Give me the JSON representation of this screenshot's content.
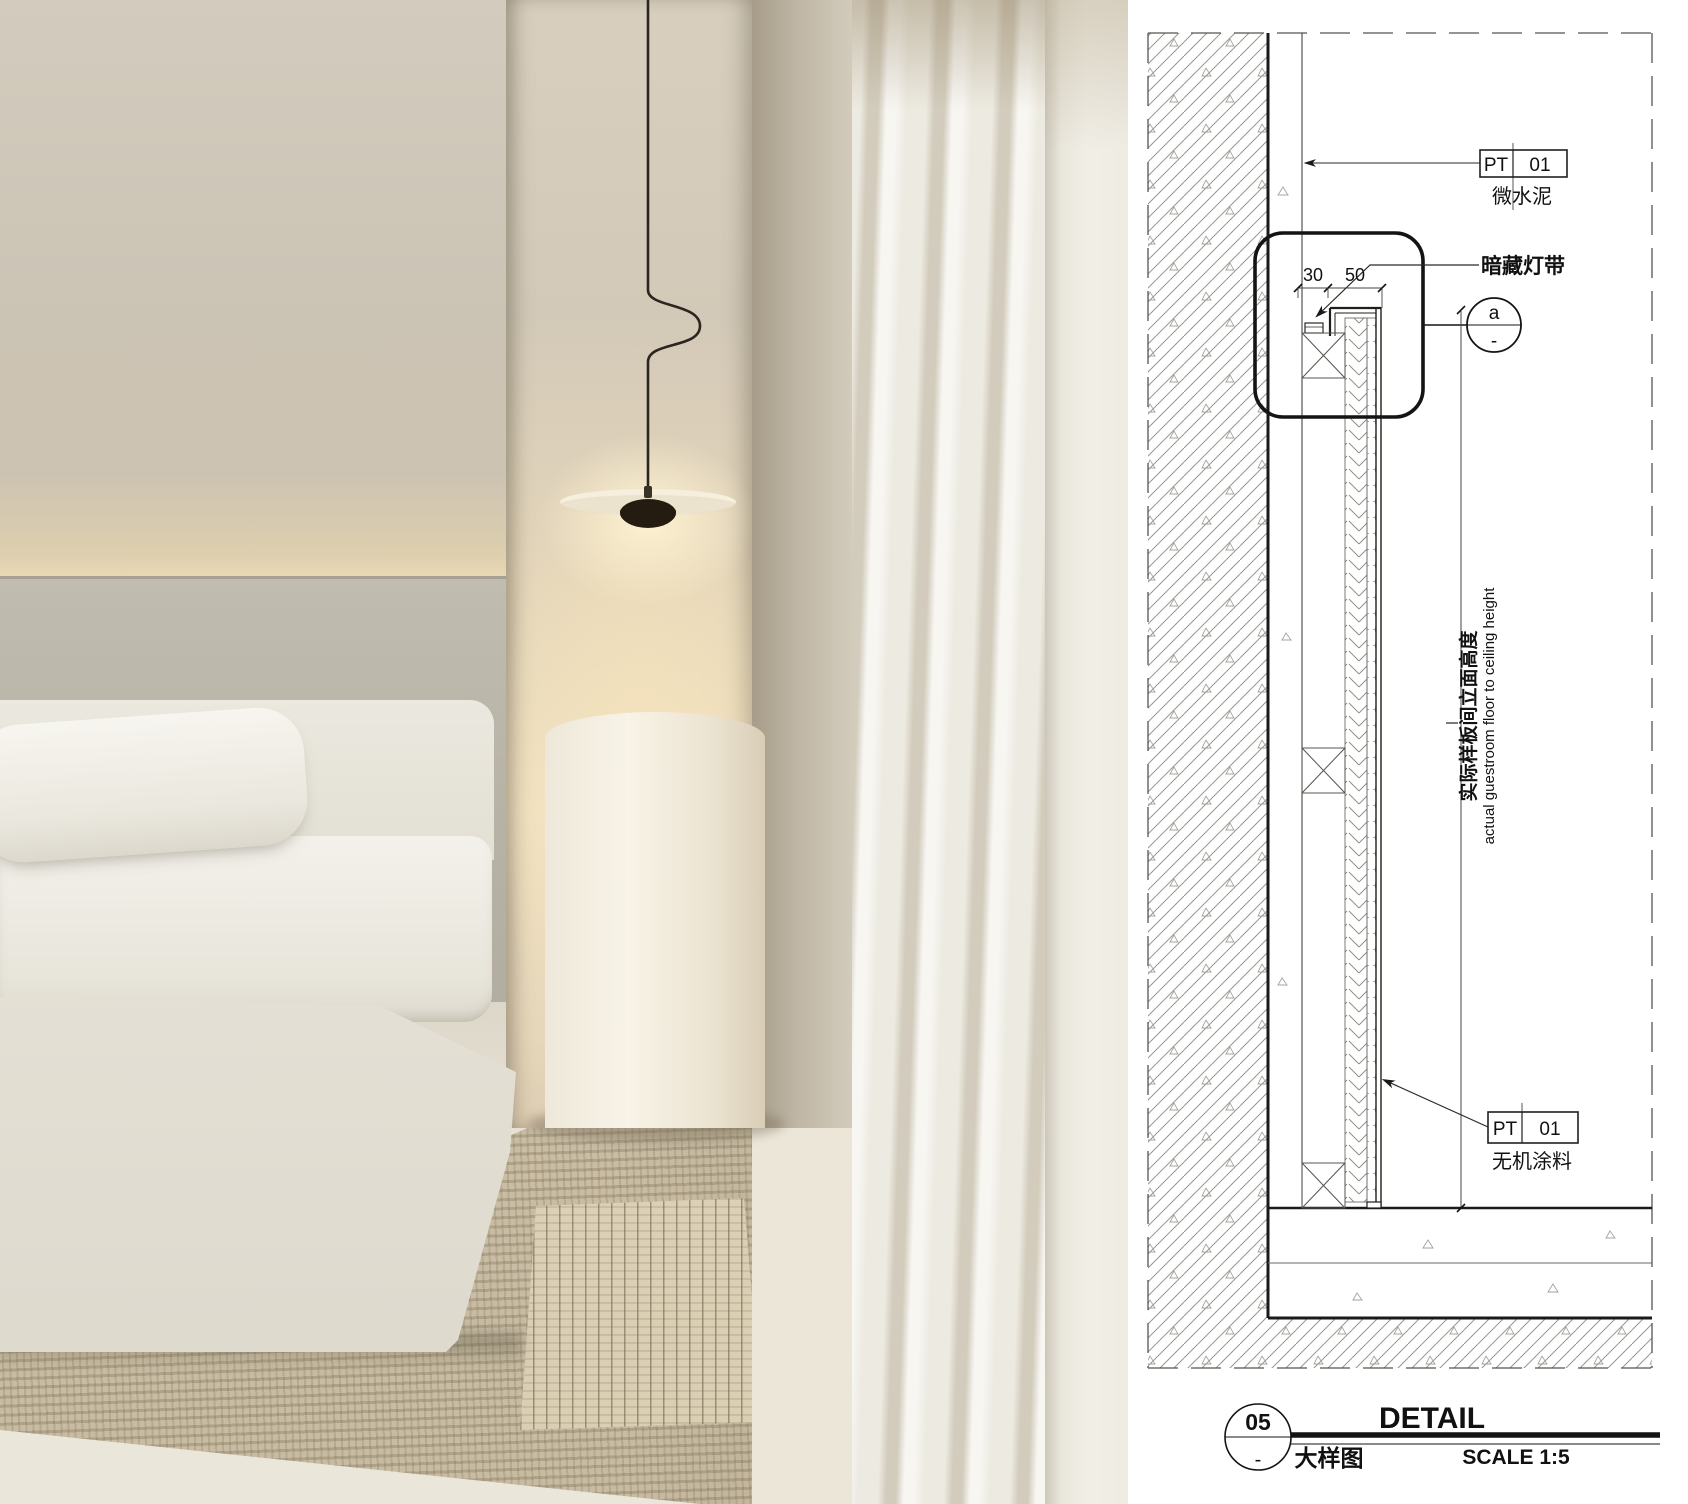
{
  "drawing": {
    "callouts": {
      "finish_top": {
        "tag_left": "PT",
        "tag_right": "01",
        "label": "微水泥"
      },
      "light_strip": {
        "label": "暗藏灯带"
      },
      "finish_bottom": {
        "tag_left": "PT",
        "tag_right": "01",
        "label": "无机涂料"
      }
    },
    "detail_marker": {
      "letter": "a",
      "ref": "-"
    },
    "dims": {
      "cove_gap": "30",
      "panel_thickness": "50"
    },
    "height_note": {
      "zh": "实际样板间立面高度",
      "en": "actual guestroom floor to ceiling height"
    },
    "title_block": {
      "number": "05",
      "sheet_ref": "-",
      "title_en": "DETAIL",
      "title_zh": "大样图",
      "scale_label": "SCALE 1:5"
    }
  },
  "palette": {
    "line_dark": "#1a1a1a",
    "line_mid": "#555550",
    "hatch": "#97968e",
    "wall_beige": "#cbc3b4",
    "panel_grey": "#b8b3a7",
    "glow_warm": "#f0e1c2",
    "curtain": "#edeae1",
    "rug": "#cbc0a8"
  }
}
